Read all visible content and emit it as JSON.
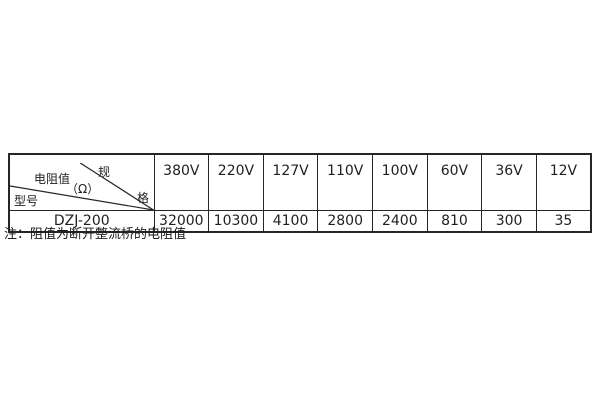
{
  "page": {
    "background": "#ffffff",
    "border_color": "#262626",
    "text_color": "#1f1f1f"
  },
  "spec_table": {
    "corner": {
      "spec_char_top": "规",
      "spec_char_bottom": "格",
      "resistance_label": "电阻值",
      "resistance_unit": "（Ω）",
      "model_label": "型号"
    },
    "voltage_columns": [
      "380V",
      "220V",
      "127V",
      "110V",
      "100V",
      "60V",
      "36V",
      "12V"
    ],
    "rows": [
      {
        "model": "DZJ-200",
        "values": [
          "32000",
          "10300",
          "4100",
          "2800",
          "2400",
          "810",
          "300",
          "35"
        ]
      }
    ]
  },
  "note": {
    "text": "注：阻值为断开整流桥的电阻值"
  }
}
